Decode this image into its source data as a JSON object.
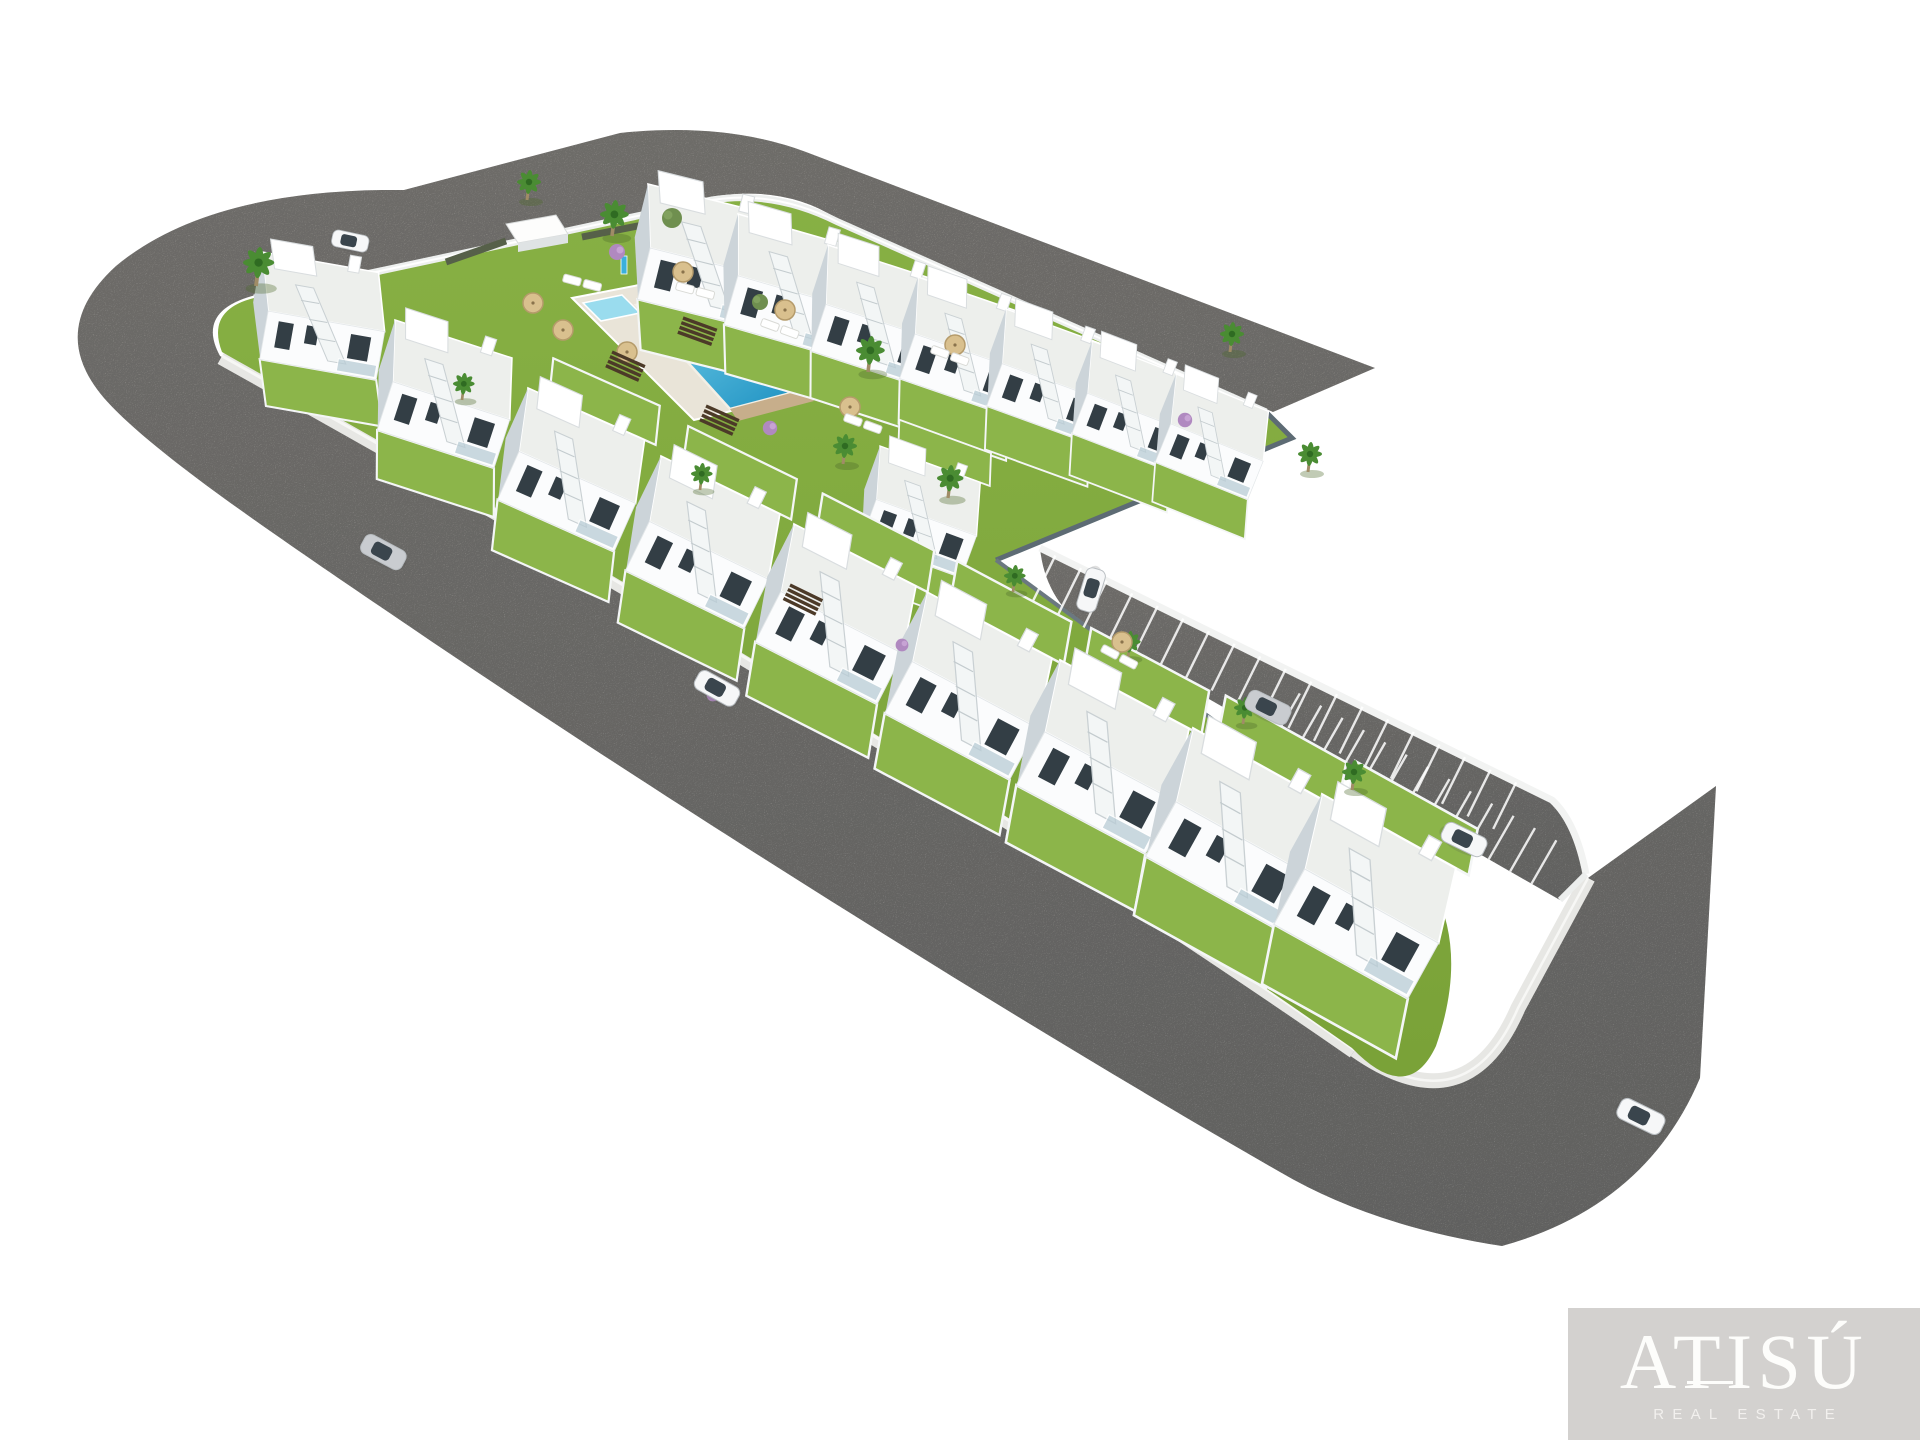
{
  "meta": {
    "type": "aerial-3d-architectural-render",
    "description": "Bird's-eye 3D rendering of a new-build residential development: two rows of white townhouses around a communal lawn with swimming pool, an L-shaped perimeter road, a parking strip with marked stalls, palm trees and cars"
  },
  "logo": {
    "brand": "ATISÚ",
    "tagline": "REAL ESTATE"
  },
  "colors": {
    "background": "#ffffff",
    "road-light": "#b2afaa",
    "road-dark": "#9d9d9b",
    "sidewalk": "#e7e7e4",
    "curb": "#f7f7f5",
    "grass": "#82aa40",
    "grass2": "#8cb54a",
    "pool-light": "#7fd7ef",
    "pool-dark": "#1b8fc0",
    "pool-kids": "#9adcee",
    "deck": "#e9e4d8",
    "stone": "#c7ae8b",
    "wood": "#4c3a28",
    "house-white": "#fbfcfd",
    "house-shadow": "#ccd4d9",
    "window": "#333e45",
    "fence-dark": "#5d6b74",
    "reed": "#566049",
    "car-white": "#f6f7f8",
    "car-silver": "#c9ccd0",
    "logo-box": "#d3d1cf",
    "logo-text": "#fdfdfb"
  },
  "scene": {
    "houses_row_top": [
      {
        "x": 648,
        "y": 184,
        "r": 14,
        "s": 1.1,
        "bg": 0
      },
      {
        "x": 738,
        "y": 214,
        "r": 16,
        "s": 1.06,
        "bg": 0
      },
      {
        "x": 828,
        "y": 245,
        "r": 18,
        "s": 1.02,
        "bg": 0
      },
      {
        "x": 918,
        "y": 277,
        "r": 19,
        "s": 0.98,
        "bg": 0
      },
      {
        "x": 1006,
        "y": 309,
        "r": 20,
        "s": 0.94,
        "bg": 0
      },
      {
        "x": 1092,
        "y": 341,
        "r": 21,
        "s": 0.9,
        "bg": 0
      },
      {
        "x": 1176,
        "y": 374,
        "r": 22,
        "s": 0.86,
        "bg": 0
      }
    ],
    "villa": {
      "x": 880,
      "y": 446,
      "r": 20,
      "s": 0.92,
      "bg": 1
    },
    "houses_row_road": [
      {
        "x": 262,
        "y": 252,
        "r": 10,
        "s": 1.02,
        "bg": 0
      },
      {
        "x": 395,
        "y": 320,
        "r": 18,
        "s": 1.06,
        "bg": 0
      },
      {
        "x": 528,
        "y": 388,
        "r": 24,
        "s": 1.1,
        "bg": 1
      },
      {
        "x": 661,
        "y": 456,
        "r": 26,
        "s": 1.14,
        "bg": 1
      },
      {
        "x": 794,
        "y": 524,
        "r": 27,
        "s": 1.18,
        "bg": 1
      },
      {
        "x": 927,
        "y": 592,
        "r": 28,
        "s": 1.22,
        "bg": 1
      },
      {
        "x": 1060,
        "y": 660,
        "r": 28,
        "s": 1.26,
        "bg": 1
      },
      {
        "x": 1193,
        "y": 728,
        "r": 29,
        "s": 1.3,
        "bg": 1
      },
      {
        "x": 1322,
        "y": 794,
        "r": 29,
        "s": 1.32,
        "bg": 1
      }
    ],
    "cars": [
      {
        "x": 334,
        "y": 229,
        "r": 12,
        "s": 0.8,
        "color": "#f6f7f8"
      },
      {
        "x": 368,
        "y": 532,
        "r": 28,
        "s": 1.0,
        "color": "#c9ccd0"
      },
      {
        "x": 702,
        "y": 668,
        "r": 29,
        "s": 1.0,
        "color": "#f6f7f8"
      },
      {
        "x": 1107,
        "y": 572,
        "r": 107,
        "s": 0.95,
        "color": "#f6f7f8"
      },
      {
        "x": 1252,
        "y": 688,
        "r": 26,
        "s": 1.0,
        "color": "#c9ccd0"
      },
      {
        "x": 1448,
        "y": 820,
        "r": 26,
        "s": 1.0,
        "color": "#f6f7f8"
      },
      {
        "x": 1624,
        "y": 1096,
        "r": 26,
        "s": 1.05,
        "color": "#f6f7f8"
      }
    ],
    "palms": [
      {
        "x": 256,
        "y": 286,
        "s": 1.3
      },
      {
        "x": 527,
        "y": 200,
        "s": 1.0
      },
      {
        "x": 612,
        "y": 236,
        "s": 1.2
      },
      {
        "x": 868,
        "y": 372,
        "s": 1.2
      },
      {
        "x": 843,
        "y": 464,
        "s": 1.0
      },
      {
        "x": 948,
        "y": 498,
        "s": 1.1
      },
      {
        "x": 1230,
        "y": 352,
        "s": 1.0
      },
      {
        "x": 1308,
        "y": 472,
        "s": 1.0
      },
      {
        "x": 1013,
        "y": 592,
        "s": 0.9
      },
      {
        "x": 1128,
        "y": 658,
        "s": 0.9
      },
      {
        "x": 1243,
        "y": 724,
        "s": 0.9
      },
      {
        "x": 1352,
        "y": 790,
        "s": 1.0
      },
      {
        "x": 462,
        "y": 400,
        "s": 0.9
      },
      {
        "x": 700,
        "y": 490,
        "s": 0.9
      }
    ],
    "trees_olive": [
      {
        "x": 672,
        "y": 218,
        "s": 1.0
      },
      {
        "x": 760,
        "y": 302,
        "s": 0.8
      }
    ],
    "trees_purple": [
      {
        "x": 617,
        "y": 252,
        "s": 1.0
      },
      {
        "x": 770,
        "y": 428,
        "s": 0.9
      },
      {
        "x": 1185,
        "y": 420,
        "s": 0.9
      },
      {
        "x": 902,
        "y": 645,
        "s": 0.8
      },
      {
        "x": 713,
        "y": 695,
        "s": 0.8
      }
    ],
    "parasols": [
      {
        "x": 533,
        "y": 303
      },
      {
        "x": 563,
        "y": 330
      },
      {
        "x": 683,
        "y": 272
      },
      {
        "x": 785,
        "y": 310
      },
      {
        "x": 850,
        "y": 407
      },
      {
        "x": 955,
        "y": 345
      },
      {
        "x": 1122,
        "y": 642
      },
      {
        "x": 627,
        "y": 352
      }
    ],
    "loungers": [
      {
        "x": 572,
        "y": 280,
        "r": 15
      },
      {
        "x": 685,
        "y": 288,
        "r": 15
      },
      {
        "x": 770,
        "y": 325,
        "r": 20
      },
      {
        "x": 940,
        "y": 352,
        "r": 20
      },
      {
        "x": 1110,
        "y": 652,
        "r": 28
      },
      {
        "x": 853,
        "y": 420,
        "r": 20
      }
    ],
    "steps_wood": [
      {
        "x": 612,
        "y": 352,
        "r": 24
      },
      {
        "x": 683,
        "y": 318,
        "r": 20
      },
      {
        "x": 706,
        "y": 406,
        "r": 24
      },
      {
        "x": 790,
        "y": 585,
        "r": 26
      }
    ],
    "pool": {
      "deck": [
        [
          572,
          298
        ],
        [
          706,
          272
        ],
        [
          826,
          388
        ],
        [
          694,
          420
        ]
      ],
      "main": [
        [
          636,
          305
        ],
        [
          712,
          289
        ],
        [
          806,
          389
        ],
        [
          730,
          409
        ]
      ],
      "kids": [
        [
          583,
          303
        ],
        [
          622,
          295
        ],
        [
          640,
          313
        ],
        [
          601,
          321
        ]
      ],
      "stone": [
        [
          806,
          389
        ],
        [
          730,
          409
        ],
        [
          738,
          421
        ],
        [
          814,
          401
        ]
      ],
      "shower": [
        621,
        272
      ]
    },
    "parking": {
      "line_nw": [
        1040,
        548,
        1552,
        800
      ],
      "line_sw": [
        1085,
        628,
        1560,
        900
      ],
      "stalls_upper": {
        "t0": 0.03,
        "t1": 0.94,
        "step": 0.05,
        "len": 52
      },
      "stalls_lower": {
        "t0": 0.4,
        "t1": 0.96,
        "step": 0.045,
        "len": 50
      }
    }
  }
}
